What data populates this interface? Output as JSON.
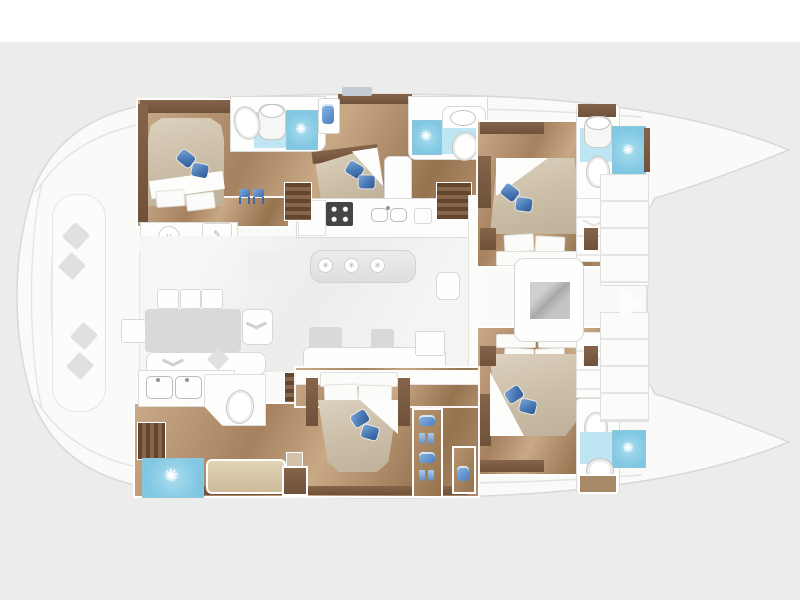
{
  "scene": {
    "type": "catamaran-yacht-floor-plan",
    "orientation": "bow-right-stern-left",
    "background_color": "#ececeb",
    "top_band_color": "#ffffff",
    "hull_fill": "#fafaf9"
  },
  "palette": {
    "wood_floor": "#b08c6a",
    "wood_trim": "#7b5c41",
    "stair_wood": "#63462f",
    "mattress": "#cabda6",
    "pillow_blue": "#4878b4",
    "bath_floor_aqua": "#bfe5f2",
    "shower_aqua": "#7fc7e2",
    "furniture_gray": "#d9d9d7",
    "furniture_white": "#fefefe"
  },
  "icons": {
    "shower_sun": "✳",
    "island_appliance": "✳",
    "desk_pencil": "✎",
    "stool_cross": "×"
  },
  "inventory": {
    "cabins": [
      "port-aft-cabin",
      "nacelle-mid-cabin",
      "port-forward-cabin",
      "owner-aft-cabin",
      "starboard-forward-cabin"
    ],
    "bathrooms": [
      "port-aft-bathroom",
      "nacelle-bathroom",
      "port-bow-bathroom",
      "starboard-bow-bathroom",
      "owner-bathroom-with-double-sink"
    ],
    "shower_count": 5,
    "toilet_count": 5,
    "bed_count": 5,
    "staircase_count": 5,
    "salon": [
      "galley-counter",
      "island-unit",
      "dining-table",
      "lounge-sofa",
      "tv-console"
    ],
    "cockpit": [
      "curved-settee",
      "throw-pillows"
    ]
  }
}
